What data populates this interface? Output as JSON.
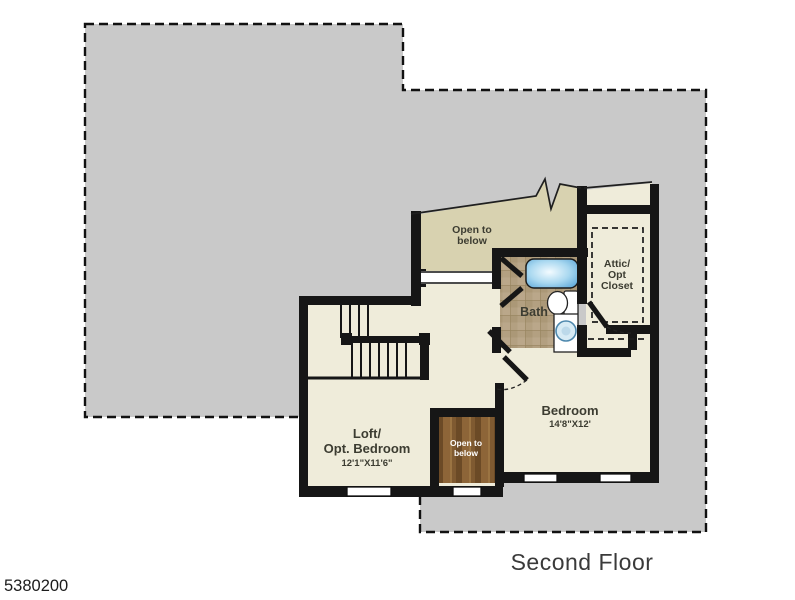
{
  "page": {
    "listing_id": "5380200",
    "floor_title": "Second Floor"
  },
  "colors": {
    "background": "#ffffff",
    "floor_below_gray": "#c9c9c9",
    "wall_black": "#161616",
    "room_beige": "#efecda",
    "open_below_khaki": "#d8d2b0",
    "bath_tile_tan": "#b3a081",
    "wood_floor_brown": "#7a5630",
    "tub_blue": "#6cb4e2",
    "label_dark": "#3c3c31",
    "title_gray": "#3a3a3a",
    "white": "#ffffff"
  },
  "rooms": {
    "open_to_below_top": {
      "line1": "Open to",
      "line2": "below"
    },
    "attic_closet": {
      "line1": "Attic/",
      "line2": "Opt",
      "line3": "Closet"
    },
    "bath": {
      "label": "Bath"
    },
    "bedroom": {
      "label": "Bedroom",
      "dims": "14'8\"X12'"
    },
    "loft": {
      "line1": "Loft/",
      "line2": "Opt. Bedroom",
      "dims": "12'1\"X11'6\""
    },
    "stairwell": {
      "line1": "Open to",
      "line2": "below"
    }
  }
}
